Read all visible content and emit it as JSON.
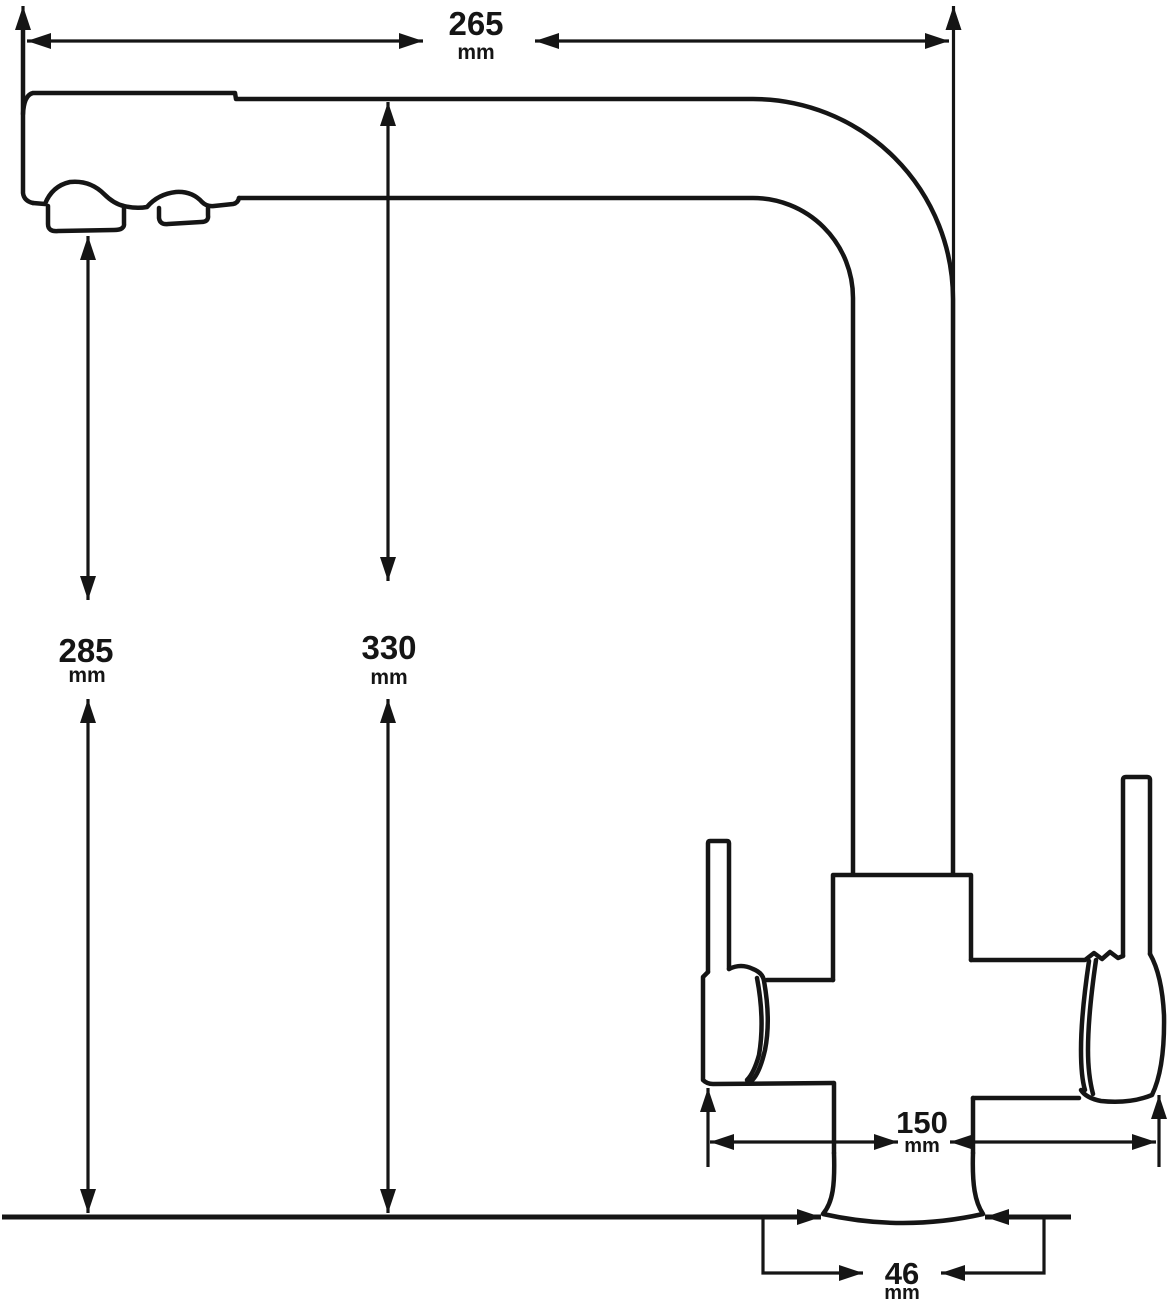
{
  "diagram": {
    "type": "technical-dimension-drawing",
    "subject": "kitchen-faucet-side-view",
    "unit": "mm",
    "stroke_color": "#151515",
    "background_color": "#ffffff",
    "dimensions": {
      "spout_reach": {
        "value": "265",
        "unit": "mm"
      },
      "total_height": {
        "value": "330",
        "unit": "mm"
      },
      "outlet_height": {
        "value": "285",
        "unit": "mm"
      },
      "handle_span": {
        "value": "150",
        "unit": "mm"
      },
      "base_width": {
        "value": "46",
        "unit": "mm"
      }
    }
  }
}
